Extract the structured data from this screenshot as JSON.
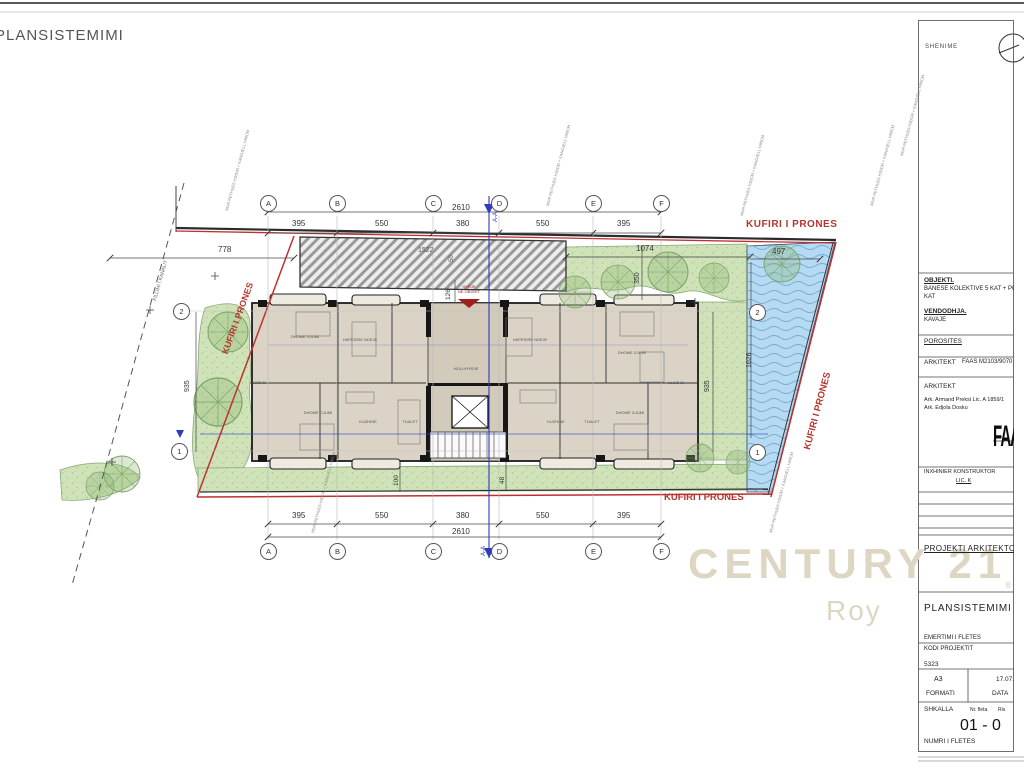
{
  "sheet": {
    "title": "PLANSISTEMIMI"
  },
  "watermark": {
    "brand": "CENTURY 21",
    "reg": "®",
    "agency": "Roy"
  },
  "boundary": {
    "label": "KUFIRI I PRONES"
  },
  "labels": {
    "canal": "FILLIMI I KANALIT",
    "entry_line1": "HYRJE",
    "entry_line2": "NE OBJEKT",
    "section": "A-A",
    "wall_note": "MUR RETHUES H30CM + KANGJELL H90CM"
  },
  "grid": {
    "columns": [
      "A",
      "B",
      "C",
      "D",
      "E",
      "F"
    ],
    "rows": [
      "2",
      "1"
    ]
  },
  "dims": {
    "top_total": "2610",
    "top_segments": [
      "395",
      "550",
      "380",
      "550",
      "395"
    ],
    "bottom_total": "2610",
    "bottom_segments": [
      "395",
      "550",
      "380",
      "550",
      "395"
    ],
    "d778": "778",
    "d1074": "1074",
    "d497": "497",
    "d1026": "1026",
    "d350": "350",
    "d126": "126",
    "d935_left": "935",
    "d935_right": "935",
    "d1522": "1522",
    "d50": "50",
    "d100": "100",
    "d48": "48"
  },
  "rooms": [
    "DHOME GJUMI",
    "HAPESIRE NDEJE",
    "HAPESIRE NDEJE",
    "DHOME GJUMI",
    "HOLL/HYRJE",
    "LLOZHE",
    "LLOZHE",
    "DHOME GJUMI",
    "KUZHINE",
    "TUALET",
    "KUZHINE",
    "TUALET",
    "DHOME GJUMI"
  ],
  "titleblock": {
    "shenime": "SHENIME",
    "objekti_label": "OBJEKTI.",
    "objekti_line1": "BANESE KOLEKTIVE 5 KAT + PODRUM",
    "objekti_line2": "KAT",
    "vendodhja_label": "VENDODHJA.",
    "vendodhja_value": "KAVAJE",
    "porosites_label": "POROSITES",
    "arkitekt_label": "ARKITEKT",
    "arkitekt_value": "FAAS M2103/9070",
    "arkitekt2_label": "ARKITEKT",
    "arkitekt_line1": "Ark. Armand  Preksi Lic. A 1859/1",
    "arkitekt_line2": "Ark. Edjola Dosku",
    "logo": "FAAS",
    "inxhinier_label": "INXHINIER KONSTRUKTOR",
    "lic_value": "LIC. K",
    "projekti": "PROJEKTI ARKITEKTONIK",
    "plansistemimi": "PLANSISTEMIMI",
    "emertimi": "EMERTIMI I FLETES",
    "kodi_label": "KODI PROJEKTIT",
    "kodi_value": "5323",
    "formati_value": "A3",
    "formati_label": "FORMATI",
    "data_value": "17.07.20",
    "data_label": "DATA",
    "shkalla_label": "SHKALLA",
    "nr_fleta_label": "Nr. fleta",
    "rishikimi_label": "Ris",
    "sheet_number": "01 - 0",
    "numri_label": "NUMRI I FLETES"
  }
}
